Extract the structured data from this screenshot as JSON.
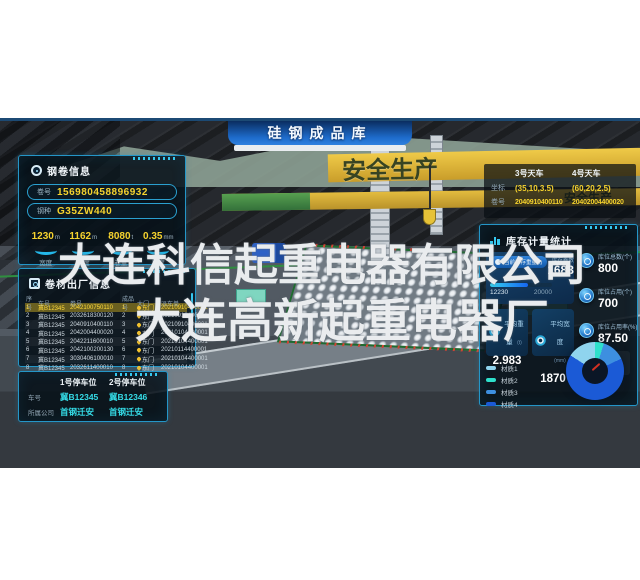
{
  "watermark": {
    "line1": "大连科信起重电器有限公司",
    "line2": "大连高新起重电器厂"
  },
  "scene": {
    "banner_title": "硅钢成品库",
    "crane_slogan": "安全生产",
    "crane_slogan_lower": "安全生产"
  },
  "coil_info": {
    "title": "钢卷信息",
    "fields": [
      {
        "label": "卷号",
        "value": "156980458896932"
      },
      {
        "label": "钢种",
        "value": "G35ZW440"
      }
    ],
    "metrics": [
      {
        "value": "1230",
        "unit": "m",
        "label": "宽度"
      },
      {
        "value": "1162",
        "unit": "m",
        "label": "长度"
      },
      {
        "value": "8080",
        "unit": "t",
        "label": "卷重"
      },
      {
        "value": "0.35",
        "unit": "mm",
        "label": "厚度"
      }
    ]
  },
  "shipping": {
    "title": "卷材出厂信息",
    "columns": [
      "序号",
      "车号",
      "卷号",
      "成品号",
      "大门",
      "派车单"
    ],
    "rows": [
      {
        "seq": "1",
        "truck": "冀B12345",
        "coil": "2042100750110",
        "product": "1",
        "gate": "东门",
        "dispatch": "20210910400001"
      },
      {
        "seq": "2",
        "truck": "冀B12345",
        "coil": "2032618300120",
        "product": "2",
        "gate": "东门",
        "dispatch": "20210910400001"
      },
      {
        "seq": "3",
        "truck": "冀B12345",
        "coil": "2040910400110",
        "product": "3",
        "gate": "东门",
        "dispatch": "20210910400001"
      },
      {
        "seq": "4",
        "truck": "冀B12345",
        "coil": "2042004400020",
        "product": "4",
        "gate": "东门",
        "dispatch": "20210104400001"
      },
      {
        "seq": "5",
        "truck": "冀B12345",
        "coil": "2042211600010",
        "product": "5",
        "gate": "东门",
        "dispatch": "20210104400001"
      },
      {
        "seq": "6",
        "truck": "冀B12345",
        "coil": "2042100200130",
        "product": "6",
        "gate": "东门",
        "dispatch": "20210114400001"
      },
      {
        "seq": "7",
        "truck": "冀B12345",
        "coil": "3030406100010",
        "product": "7",
        "gate": "东门",
        "dispatch": "20210104400001"
      },
      {
        "seq": "8",
        "truck": "冀B12345",
        "coil": "2032611400010",
        "product": "8",
        "gate": "东门",
        "dispatch": "20210104400001"
      }
    ]
  },
  "parking": {
    "plate_label": "车号",
    "company_label": "所属公司",
    "spots": [
      {
        "title": "1号停车位",
        "plate": "冀B12345",
        "company": "首钢迁安"
      },
      {
        "title": "2号停车位",
        "plate": "冀B12346",
        "company": "首钢迁安"
      }
    ]
  },
  "cranes": {
    "coord_label": "坐标",
    "coil_label": "卷号",
    "items": [
      {
        "name": "3号天车",
        "coord": "(35,10,3.5)",
        "coil": "2040910400110"
      },
      {
        "name": "4号天车",
        "coord": "(60,20,2.5)",
        "coil": "20402004400020"
      }
    ]
  },
  "inventory": {
    "title": "库存计量统计",
    "weight_card": {
      "label": "当前库存重量(t)",
      "current": 12230,
      "total": 20000,
      "count_label": "库存卷数",
      "count": "1683"
    },
    "avg_cards": [
      {
        "label": "平均重量",
        "sub": "(t)",
        "value": "2.983"
      },
      {
        "label": "平均宽度",
        "sub": "(mm)",
        "value": "1870"
      }
    ],
    "stats": [
      {
        "label": "库位总数(个)",
        "value": "800"
      },
      {
        "label": "库位占用(个)",
        "value": "700"
      },
      {
        "label": "库位占用率(%)",
        "value": "87.50"
      }
    ],
    "legend": [
      {
        "label": "材质1",
        "color": "#8fd4ee"
      },
      {
        "label": "材质2",
        "color": "#2ee0cb"
      },
      {
        "label": "材质3",
        "color": "#3d8fe0"
      },
      {
        "label": "材质4",
        "color": "#1b5ad6"
      }
    ]
  },
  "chart_data": {
    "type": "pie",
    "categories": [
      "材质2",
      "材质3",
      "材质4",
      "材质1"
    ],
    "values": [
      5,
      13,
      66,
      16
    ],
    "colors": [
      "#2ee0cb",
      "#3d8fe0",
      "#1b5ad6",
      "#8fd4ee"
    ],
    "legend_position": "left"
  }
}
